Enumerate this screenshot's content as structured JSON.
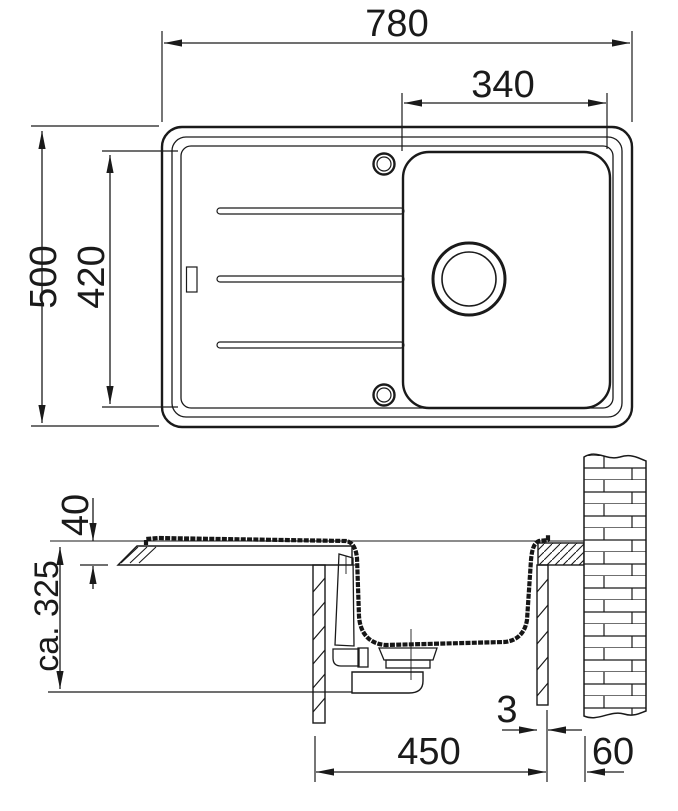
{
  "diagram": {
    "title": "sink-installation-drawing",
    "colors": {
      "line": "#1a1a1a",
      "background": "#ffffff"
    },
    "top_view": {
      "overall_width_mm": "780",
      "bowl_width_mm": "340",
      "overall_depth_mm": "500",
      "inner_depth_mm": "420"
    },
    "section_view": {
      "countertop_thickness_mm": "40",
      "depth_below_top_mm": "ca. 325",
      "cabinet_width_mm": "450",
      "rear_gap_mm": "3",
      "wall_distance_mm": "60"
    }
  }
}
